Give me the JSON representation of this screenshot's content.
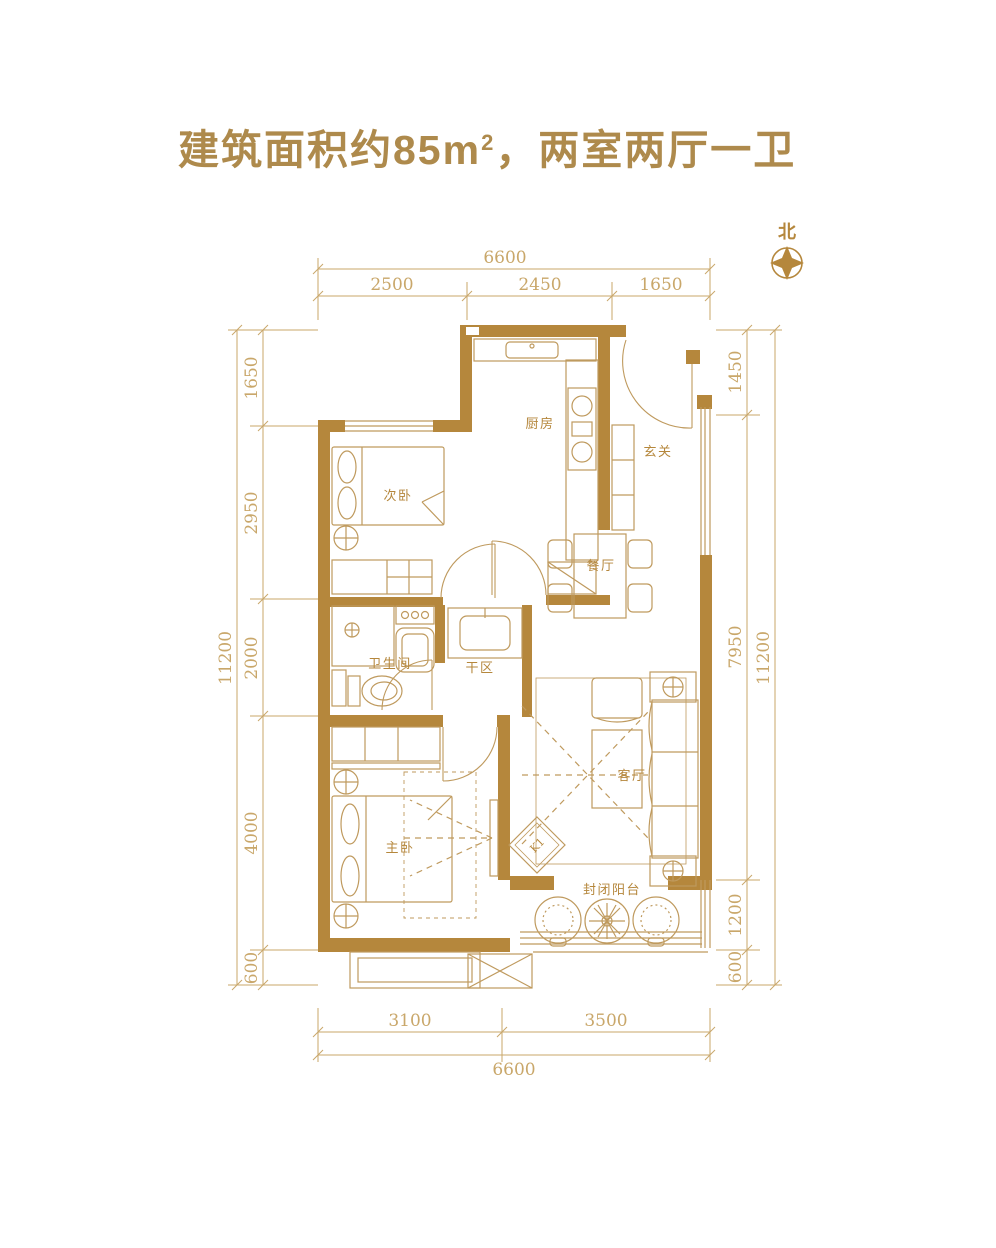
{
  "title": {
    "prefix": "建筑面积约85m",
    "sup": "2",
    "suffix": "，两室两厅一卫"
  },
  "compass": {
    "label": "北"
  },
  "rooms": {
    "second_bedroom": "次卧",
    "kitchen": "厨房",
    "foyer": "玄关",
    "dining": "餐厅",
    "bathroom": "卫生间",
    "dry_area": "干区",
    "living": "客厅",
    "master_bedroom": "主卧",
    "balcony": "封闭阳台",
    "column_mark": "K1"
  },
  "dimensions": {
    "top": {
      "total": "6600",
      "segments": [
        "2500",
        "2450",
        "1650"
      ]
    },
    "bottom": {
      "total": "6600",
      "segments": [
        "3100",
        "3500"
      ]
    },
    "left": {
      "total": "11200",
      "segments": [
        "1650",
        "2950",
        "2000",
        "4000",
        "600"
      ]
    },
    "right": {
      "total": "11200",
      "segments": [
        "1450",
        "7950",
        "1200",
        "600"
      ]
    }
  },
  "colors": {
    "wall": "#b5873c",
    "furniture_line": "#bf9a5e",
    "dimension_line": "#c9a76a",
    "title_text": "#ae8a4c"
  }
}
